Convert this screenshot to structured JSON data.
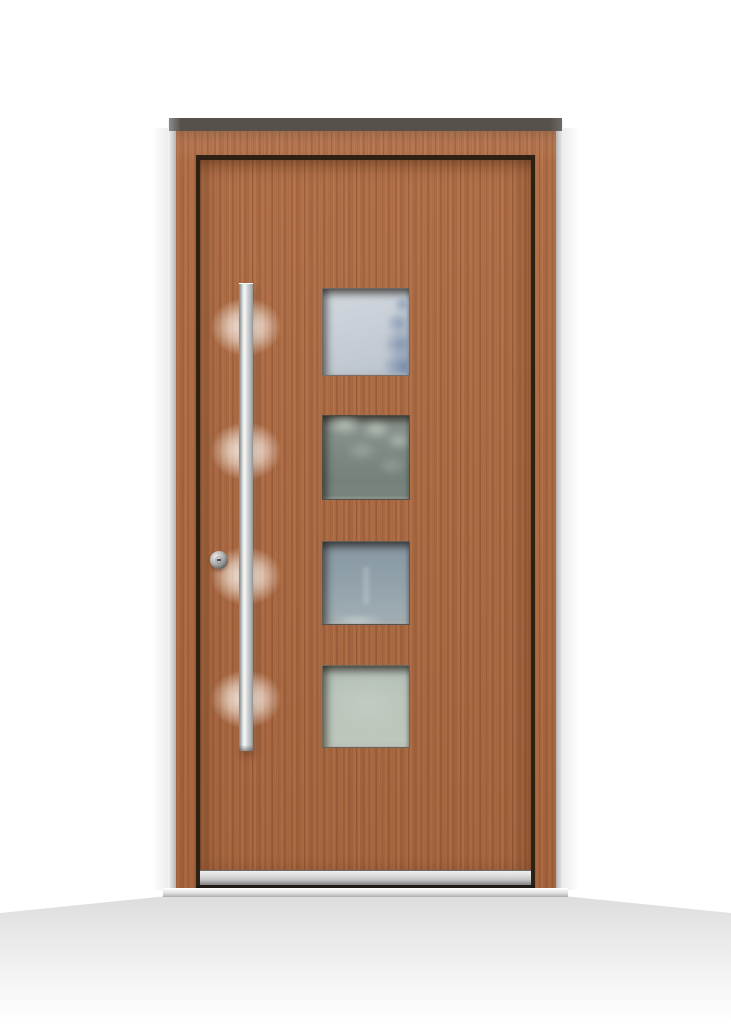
{
  "image": {
    "type": "product-photo",
    "subject": "modern-wooden-entrance-door",
    "background_color": "#ffffff",
    "text_content": "none"
  },
  "theme": {
    "wood-base": "#ae6a42",
    "wood-grain-dark": "#8a5130",
    "wood-grain-light": "#c57f4f",
    "groove": "#2e2012",
    "top-band": "#57514c",
    "frame-edge-dark": "#b5b5b5",
    "handle-bright": "#f7f8f8",
    "cylinder-face": "#d2d2d2",
    "weather-bar-light": "#f0f0f0",
    "weather-bar-dark": "#77777a",
    "sill-light": "#fafafa",
    "sill-dark": "#ababab",
    "floor": "#dcdcdc"
  },
  "door": {
    "leaf_wood_color": "#ae6a42",
    "frame_wood_color": "#ab6740",
    "handle_style": "vertical-stainless-bar",
    "handle_color": "#d9dbdc",
    "lock_cylinder_color": "#9b9b9b",
    "windows_count": 4,
    "windows": [
      {
        "id": "window-1",
        "glass_color": "#c8cfd7",
        "reflection": "conifer-tree",
        "reflection_color": "#7e93b0"
      },
      {
        "id": "window-2",
        "glass_color": "#7e8b84",
        "reflection": "foliage-highlights",
        "reflection_color": "#cfd8cc"
      },
      {
        "id": "window-3",
        "glass_color": "#93a2ab",
        "reflection": "soft-sky-streak",
        "reflection_color": "#aebbbf"
      },
      {
        "id": "window-4",
        "glass_color": "#b8c3b9",
        "reflection": "none",
        "reflection_color": "#c2ccc0"
      }
    ]
  }
}
